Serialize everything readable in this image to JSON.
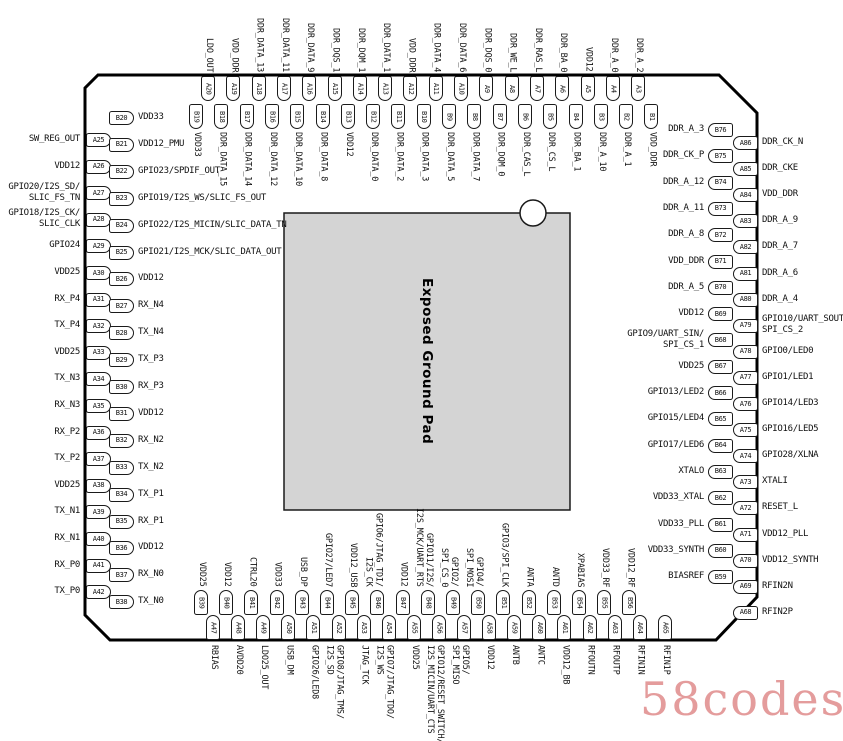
{
  "pad": {
    "label": "Exposed Ground Pad",
    "fill": "#d4d4d4"
  },
  "watermark": {
    "text": "58codes",
    "color": "#e49c9c"
  },
  "colors": {
    "chip_border": "#000000",
    "pin_border": "#1a1a1a",
    "text": "#111111"
  },
  "sides": {
    "top_outer": {
      "pins": [
        {
          "id": "A20",
          "label": "LDO_OUT"
        },
        {
          "id": "A19",
          "label": "VDD_DDR"
        },
        {
          "id": "A18",
          "label": "DDR_DATA_13"
        },
        {
          "id": "A17",
          "label": "DDR_DATA_11"
        },
        {
          "id": "A16",
          "label": "DDR_DATA_9"
        },
        {
          "id": "A15",
          "label": "DDR_DQS_1"
        },
        {
          "id": "A14",
          "label": "DDR_DQM_1"
        },
        {
          "id": "A13",
          "label": "DDR_DATA_1"
        },
        {
          "id": "A12",
          "label": "VDD_DDR"
        },
        {
          "id": "A11",
          "label": "DDR_DATA_4"
        },
        {
          "id": "A10",
          "label": "DDR_DATA_6"
        },
        {
          "id": "A9",
          "label": "DDR_DQS_0"
        },
        {
          "id": "A8",
          "label": "DDR_WE_L"
        },
        {
          "id": "A7",
          "label": "DDR_RAS_L"
        },
        {
          "id": "A6",
          "label": "DDR_BA_0"
        },
        {
          "id": "A5",
          "label": "VDD12"
        },
        {
          "id": "A4",
          "label": "DDR_A_0"
        },
        {
          "id": "A3",
          "label": "DDR_A_2"
        }
      ]
    },
    "top_inner": {
      "pins": [
        {
          "id": "B19",
          "label": "VDD33"
        },
        {
          "id": "B18",
          "label": "DDR_DATA_15"
        },
        {
          "id": "B17",
          "label": "DDR_DATA_14"
        },
        {
          "id": "B16",
          "label": "DDR_DATA_12"
        },
        {
          "id": "B15",
          "label": "DDR_DATA_10"
        },
        {
          "id": "B14",
          "label": "DDR_DATA_8"
        },
        {
          "id": "B13",
          "label": "VDD12"
        },
        {
          "id": "B12",
          "label": "DDR_DATA_0"
        },
        {
          "id": "B11",
          "label": "DDR_DATA_2"
        },
        {
          "id": "B10",
          "label": "DDR_DATA_3"
        },
        {
          "id": "B9",
          "label": "DDR_DATA_5"
        },
        {
          "id": "B8",
          "label": "DDR_DATA_7"
        },
        {
          "id": "B7",
          "label": "DDR_DQM_0"
        },
        {
          "id": "B6",
          "label": "DDR_CAS_L"
        },
        {
          "id": "B5",
          "label": "DDR_CS_L"
        },
        {
          "id": "B4",
          "label": "DDR_BA_1"
        },
        {
          "id": "B3",
          "label": "DDR_A_10"
        },
        {
          "id": "B2",
          "label": "DDR_A_1"
        },
        {
          "id": "B1",
          "label": "VDD_DDR"
        }
      ]
    },
    "left_outer": {
      "pins": [
        {
          "id": "A25",
          "label": "SW_REG_OUT"
        },
        {
          "id": "A26",
          "label": "VDD12"
        },
        {
          "id": "A27",
          "label": [
            "GPIO20/I2S_SD/",
            "SLIC_FS_TN"
          ]
        },
        {
          "id": "A28",
          "label": [
            "GPIO18/I2S_CK/",
            "SLIC_CLK"
          ]
        },
        {
          "id": "A29",
          "label": "GPIO24"
        },
        {
          "id": "A30",
          "label": "VDD25"
        },
        {
          "id": "A31",
          "label": "RX_P4"
        },
        {
          "id": "A32",
          "label": "TX_P4"
        },
        {
          "id": "A33",
          "label": "VDD25"
        },
        {
          "id": "A34",
          "label": "TX_N3"
        },
        {
          "id": "A35",
          "label": "RX_N3"
        },
        {
          "id": "A36",
          "label": "RX_P2"
        },
        {
          "id": "A37",
          "label": "TX_P2"
        },
        {
          "id": "A38",
          "label": "VDD25"
        },
        {
          "id": "A39",
          "label": "TX_N1"
        },
        {
          "id": "A40",
          "label": "RX_N1"
        },
        {
          "id": "A41",
          "label": "RX_P0"
        },
        {
          "id": "A42",
          "label": "TX_P0"
        }
      ]
    },
    "left_inner": {
      "pins": [
        {
          "id": "B20",
          "label": "VDD33"
        },
        {
          "id": "B21",
          "label": "VDD12_PMU"
        },
        {
          "id": "B22",
          "label": "GPIO23/SPDIF_OUT"
        },
        {
          "id": "B23",
          "label": "GPIO19/I2S_WS/SLIC_FS_OUT"
        },
        {
          "id": "B24",
          "label": "GPIO22/I2S_MICIN/SLIC_DATA_TN"
        },
        {
          "id": "B25",
          "label": "GPIO21/I2S_MCK/SLIC_DATA_OUT"
        },
        {
          "id": "B26",
          "label": "VDD12"
        },
        {
          "id": "B27",
          "label": "RX_N4"
        },
        {
          "id": "B28",
          "label": "TX_N4"
        },
        {
          "id": "B29",
          "label": "TX_P3"
        },
        {
          "id": "B30",
          "label": "RX_P3"
        },
        {
          "id": "B31",
          "label": "VDD12"
        },
        {
          "id": "B32",
          "label": "RX_N2"
        },
        {
          "id": "B33",
          "label": "TX_N2"
        },
        {
          "id": "B34",
          "label": "TX_P1"
        },
        {
          "id": "B35",
          "label": "RX_P1"
        },
        {
          "id": "B36",
          "label": "VDD12"
        },
        {
          "id": "B37",
          "label": "RX_N0"
        },
        {
          "id": "B38",
          "label": "TX_N0"
        }
      ]
    },
    "right_inner": {
      "pins": [
        {
          "id": "B76",
          "label": "DDR_A_3"
        },
        {
          "id": "B75",
          "label": "DDR_CK_P"
        },
        {
          "id": "B74",
          "label": "DDR_A_12"
        },
        {
          "id": "B73",
          "label": "DDR_A_11"
        },
        {
          "id": "B72",
          "label": "DDR_A_8"
        },
        {
          "id": "B71",
          "label": "VDD_DDR"
        },
        {
          "id": "B70",
          "label": "DDR_A_5"
        },
        {
          "id": "B69",
          "label": "VDD12"
        },
        {
          "id": "B68",
          "label": [
            "GPIO9/UART_SIN/",
            "SPI_CS_1"
          ]
        },
        {
          "id": "B67",
          "label": "VDD25"
        },
        {
          "id": "B66",
          "label": "GPIO13/LED2"
        },
        {
          "id": "B65",
          "label": "GPIO15/LED4"
        },
        {
          "id": "B64",
          "label": "GPIO17/LED6"
        },
        {
          "id": "B63",
          "label": "XTALO"
        },
        {
          "id": "B62",
          "label": "VDD33_XTAL"
        },
        {
          "id": "B61",
          "label": "VDD33_PLL"
        },
        {
          "id": "B60",
          "label": "VDD33_SYNTH"
        },
        {
          "id": "B59",
          "label": "BIASREF"
        }
      ]
    },
    "right_outer": {
      "pins": [
        {
          "id": "A86",
          "label": "DDR_CK_N"
        },
        {
          "id": "A85",
          "label": "DDR_CKE"
        },
        {
          "id": "A84",
          "label": "VDD_DDR"
        },
        {
          "id": "A83",
          "label": "DDR_A_9"
        },
        {
          "id": "A82",
          "label": "DDR_A_7"
        },
        {
          "id": "A81",
          "label": "DDR_A_6"
        },
        {
          "id": "A80",
          "label": "DDR_A_4"
        },
        {
          "id": "A79",
          "label": [
            "GPIO10/UART_SOUT,",
            "SPI_CS_2"
          ]
        },
        {
          "id": "A78",
          "label": "GPIO0/LED0"
        },
        {
          "id": "A77",
          "label": "GPIO1/LED1"
        },
        {
          "id": "A76",
          "label": "GPIO14/LED3"
        },
        {
          "id": "A75",
          "label": "GPIO16/LED5"
        },
        {
          "id": "A74",
          "label": "GPIO28/XLNA"
        },
        {
          "id": "A73",
          "label": "XTALI"
        },
        {
          "id": "A72",
          "label": "RESET_L"
        },
        {
          "id": "A71",
          "label": "VDD12_PLL"
        },
        {
          "id": "A70",
          "label": "VDD12_SYNTH"
        },
        {
          "id": "A69",
          "label": "RFIN2N"
        },
        {
          "id": "A68",
          "label": "RFIN2P"
        }
      ]
    },
    "bottom_inner": {
      "pins": [
        {
          "id": "B39",
          "label": "VDD25"
        },
        {
          "id": "B40",
          "label": "VDD12"
        },
        {
          "id": "B41",
          "label": "CTRL20"
        },
        {
          "id": "B42",
          "label": "VDD33"
        },
        {
          "id": "B43",
          "label": "USB_DP"
        },
        {
          "id": "B44",
          "label": "GPIO27/LED7"
        },
        {
          "id": "B45",
          "label": "VDD12_USB"
        },
        {
          "id": "B46",
          "label": [
            "GPIO6/JTAG_TDI/",
            "I2S_CK"
          ]
        },
        {
          "id": "B47",
          "label": "VDD12"
        },
        {
          "id": "B48",
          "label": [
            "GPIO11/I2S/",
            "I2S_MCK/UART_RTS"
          ]
        },
        {
          "id": "B49",
          "label": [
            "GPIO2/",
            "SPI_CS_0"
          ]
        },
        {
          "id": "B50",
          "label": [
            "GPIO4/",
            "SPI_MOSI"
          ]
        },
        {
          "id": "B51",
          "label": "GPIO3/SPI_CLK"
        },
        {
          "id": "B52",
          "label": "ANTA"
        },
        {
          "id": "B53",
          "label": "ANTD"
        },
        {
          "id": "B54",
          "label": "XPABIAS"
        },
        {
          "id": "B55",
          "label": "VDD33_RF"
        },
        {
          "id": "B56",
          "label": "VDD12_RF"
        }
      ]
    },
    "bottom_outer": {
      "pins": [
        {
          "id": "A47",
          "label": "RBIAS"
        },
        {
          "id": "A48",
          "label": "AVDD20"
        },
        {
          "id": "A49",
          "label": "LDO25_OUT"
        },
        {
          "id": "A50",
          "label": "USB_DM"
        },
        {
          "id": "A51",
          "label": "GPIO26/LED8"
        },
        {
          "id": "A52",
          "label": [
            "GPIO8/JTAG_TMS/",
            "I2S_SD"
          ]
        },
        {
          "id": "A53",
          "label": "JTAG_TCK"
        },
        {
          "id": "A54",
          "label": [
            "GPIO7/JTAG_TDO/",
            "I2S_WS"
          ]
        },
        {
          "id": "A55",
          "label": "VDD25"
        },
        {
          "id": "A56",
          "label": [
            "GPIO12/RESET_SWITCH/",
            "I2S_MICIN/UART_CTS"
          ]
        },
        {
          "id": "A57",
          "label": [
            "GPIO5/",
            "SPI_MISO"
          ]
        },
        {
          "id": "A58",
          "label": "VDD12"
        },
        {
          "id": "A59",
          "label": "ANTB"
        },
        {
          "id": "A60",
          "label": "ANTC"
        },
        {
          "id": "A61",
          "label": "VDD12_BB"
        },
        {
          "id": "A62",
          "label": "RFOUTN"
        },
        {
          "id": "A63",
          "label": "RFOUTP"
        },
        {
          "id": "A64",
          "label": "RFIN1N"
        },
        {
          "id": "A65",
          "label": "RFIN1P"
        }
      ]
    }
  }
}
